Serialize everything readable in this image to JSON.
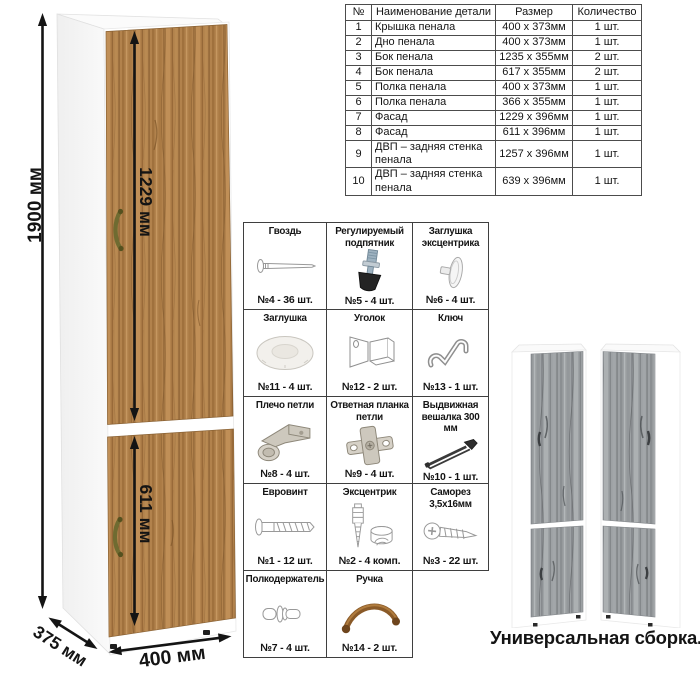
{
  "dimensions": {
    "height": "1900 мм",
    "top_door": "1229 мм",
    "bottom_door": "611 мм",
    "depth": "375 мм",
    "width": "400 мм"
  },
  "parts_table": {
    "headers": {
      "num": "№",
      "name": "Наименование детали",
      "size": "Размер",
      "qty": "Количество"
    },
    "rows": [
      {
        "num": "1",
        "name": "Крышка пенала",
        "size": "400 х 373мм",
        "qty": "1 шт."
      },
      {
        "num": "2",
        "name": "Дно пенала",
        "size": "400 х 373мм",
        "qty": "1 шт."
      },
      {
        "num": "3",
        "name": "Бок пенала",
        "size": "1235 х 355мм",
        "qty": "2 шт."
      },
      {
        "num": "4",
        "name": "Бок пенала",
        "size": "617 х 355мм",
        "qty": "2 шт."
      },
      {
        "num": "5",
        "name": "Полка пенала",
        "size": "400 х 373мм",
        "qty": "1 шт."
      },
      {
        "num": "6",
        "name": "Полка пенала",
        "size": "366 х 355мм",
        "qty": "1 шт."
      },
      {
        "num": "7",
        "name": "Фасад",
        "size": "1229 х 396мм",
        "qty": "1 шт."
      },
      {
        "num": "8",
        "name": "Фасад",
        "size": "611 х 396мм",
        "qty": "1 шт."
      },
      {
        "num": "9",
        "name": "ДВП – задняя стенка пенала",
        "size": "1257 х 396мм",
        "qty": "1 шт."
      },
      {
        "num": "10",
        "name": "ДВП – задняя стенка пенала",
        "size": "639 х 396мм",
        "qty": "1 шт."
      }
    ]
  },
  "hardware": {
    "items": [
      {
        "name": "Гвоздь",
        "count": "№4 - 36 шт.",
        "icon": "nail-icon"
      },
      {
        "name": "Регулируемый подпятник",
        "count": "№5 - 4 шт.",
        "icon": "adjustable-foot-icon"
      },
      {
        "name": "Заглушка эксцентрика",
        "count": "№6 - 4 шт.",
        "icon": "cam-cap-icon"
      },
      {
        "name": "Заглушка",
        "count": "№11 - 4 шт.",
        "icon": "cap-icon"
      },
      {
        "name": "Уголок",
        "count": "№12 - 2 шт.",
        "icon": "corner-bracket-icon"
      },
      {
        "name": "Ключ",
        "count": "№13 - 1 шт.",
        "icon": "hex-key-icon"
      },
      {
        "name": "Плечо петли",
        "count": "№8 - 4 шт.",
        "icon": "hinge-arm-icon"
      },
      {
        "name": "Ответная планка петли",
        "count": "№9 - 4 шт.",
        "icon": "hinge-plate-icon"
      },
      {
        "name": "Выдвижная вешалка 300 мм",
        "count": "№10 - 1 шт.",
        "icon": "pullout-hanger-icon"
      },
      {
        "name": "Евровинт",
        "count": "№1 - 12 шт.",
        "icon": "euro-screw-icon"
      },
      {
        "name": "Эксцентрик",
        "count": "№2 - 4 комп.",
        "icon": "eccentric-cam-icon"
      },
      {
        "name": "Саморез 3,5х16мм",
        "count": "№3 - 22 шт.",
        "icon": "self-tapping-screw-icon"
      },
      {
        "name": "Полкодержатель",
        "count": "№7 - 4 шт.",
        "icon": "shelf-pin-icon"
      },
      {
        "name": "Ручка",
        "count": "№14 - 2 шт.",
        "icon": "handle-icon"
      }
    ]
  },
  "variants": {
    "caption": "Универсальная сборка."
  },
  "colors": {
    "wood": "#b2824c",
    "wood_light": "#c59760",
    "wood_dark": "#8c6133",
    "gray_wood": "#9da1a4",
    "handle_bronze": "#6f6b31",
    "arrow": "#141414",
    "table_border": "#4c4c4c"
  }
}
